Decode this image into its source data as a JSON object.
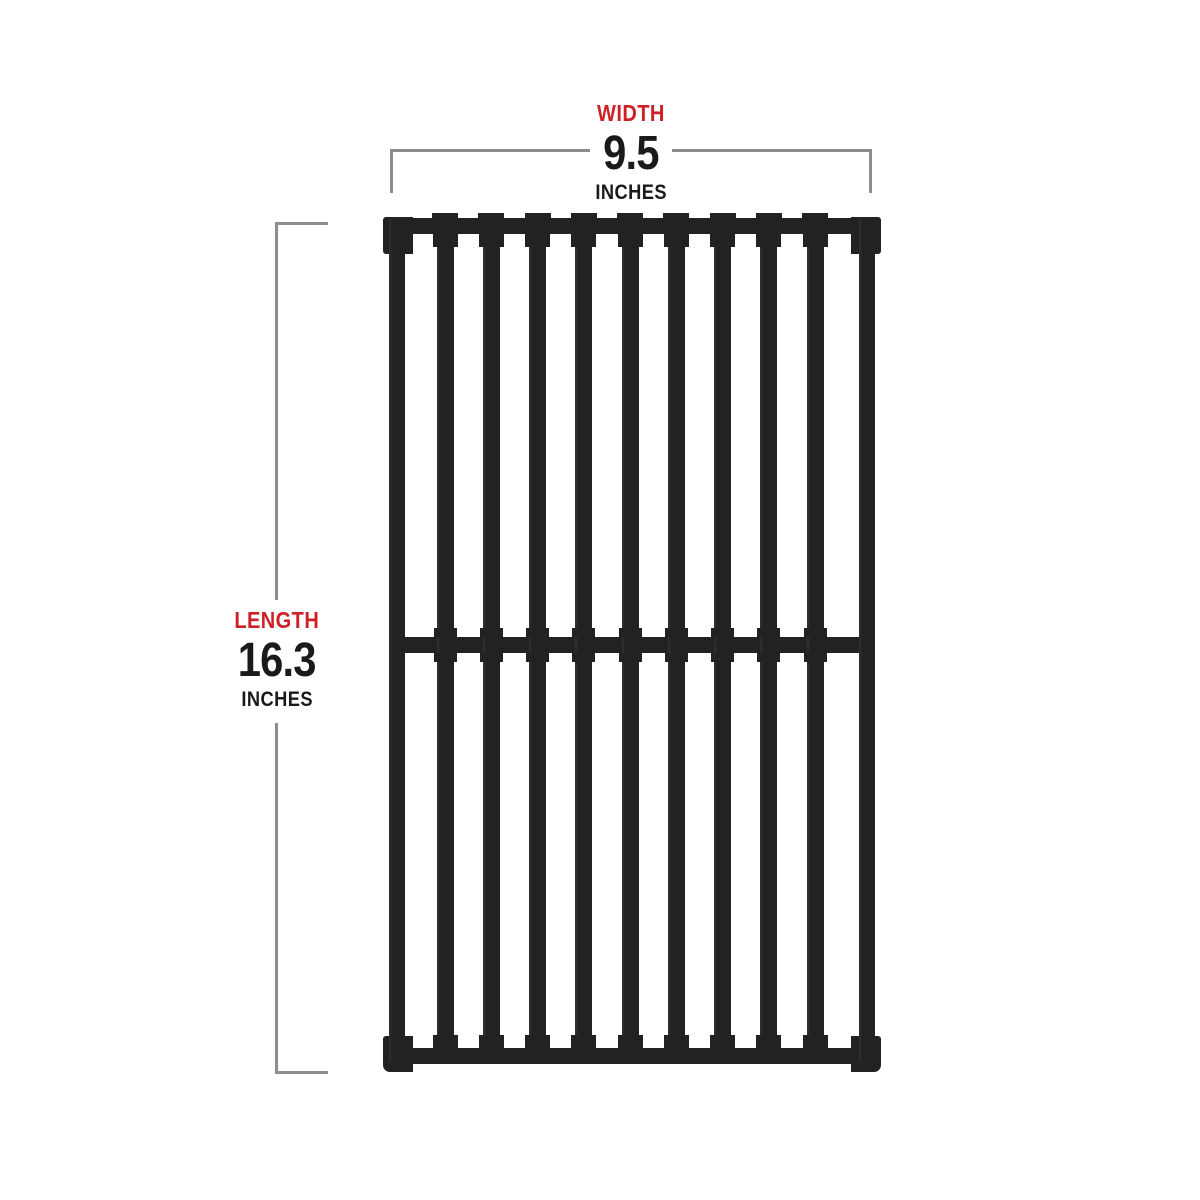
{
  "diagram": {
    "subject": "grill cooking grate with dimension callouts",
    "accent_color": "#ce2127",
    "text_color": "#1a1a1a",
    "line_color": "#8d8d8d",
    "grate_color": "#222222",
    "background_color": "#ffffff"
  },
  "width_label": {
    "name": "WIDTH",
    "value": "9.5",
    "unit": "INCHES"
  },
  "length_label": {
    "name": "LENGTH",
    "value": "16.3",
    "unit": "INCHES"
  },
  "grate": {
    "interior_bars": 9,
    "frame_bars": 2,
    "horizontal_rails": 3,
    "sections": 2
  }
}
